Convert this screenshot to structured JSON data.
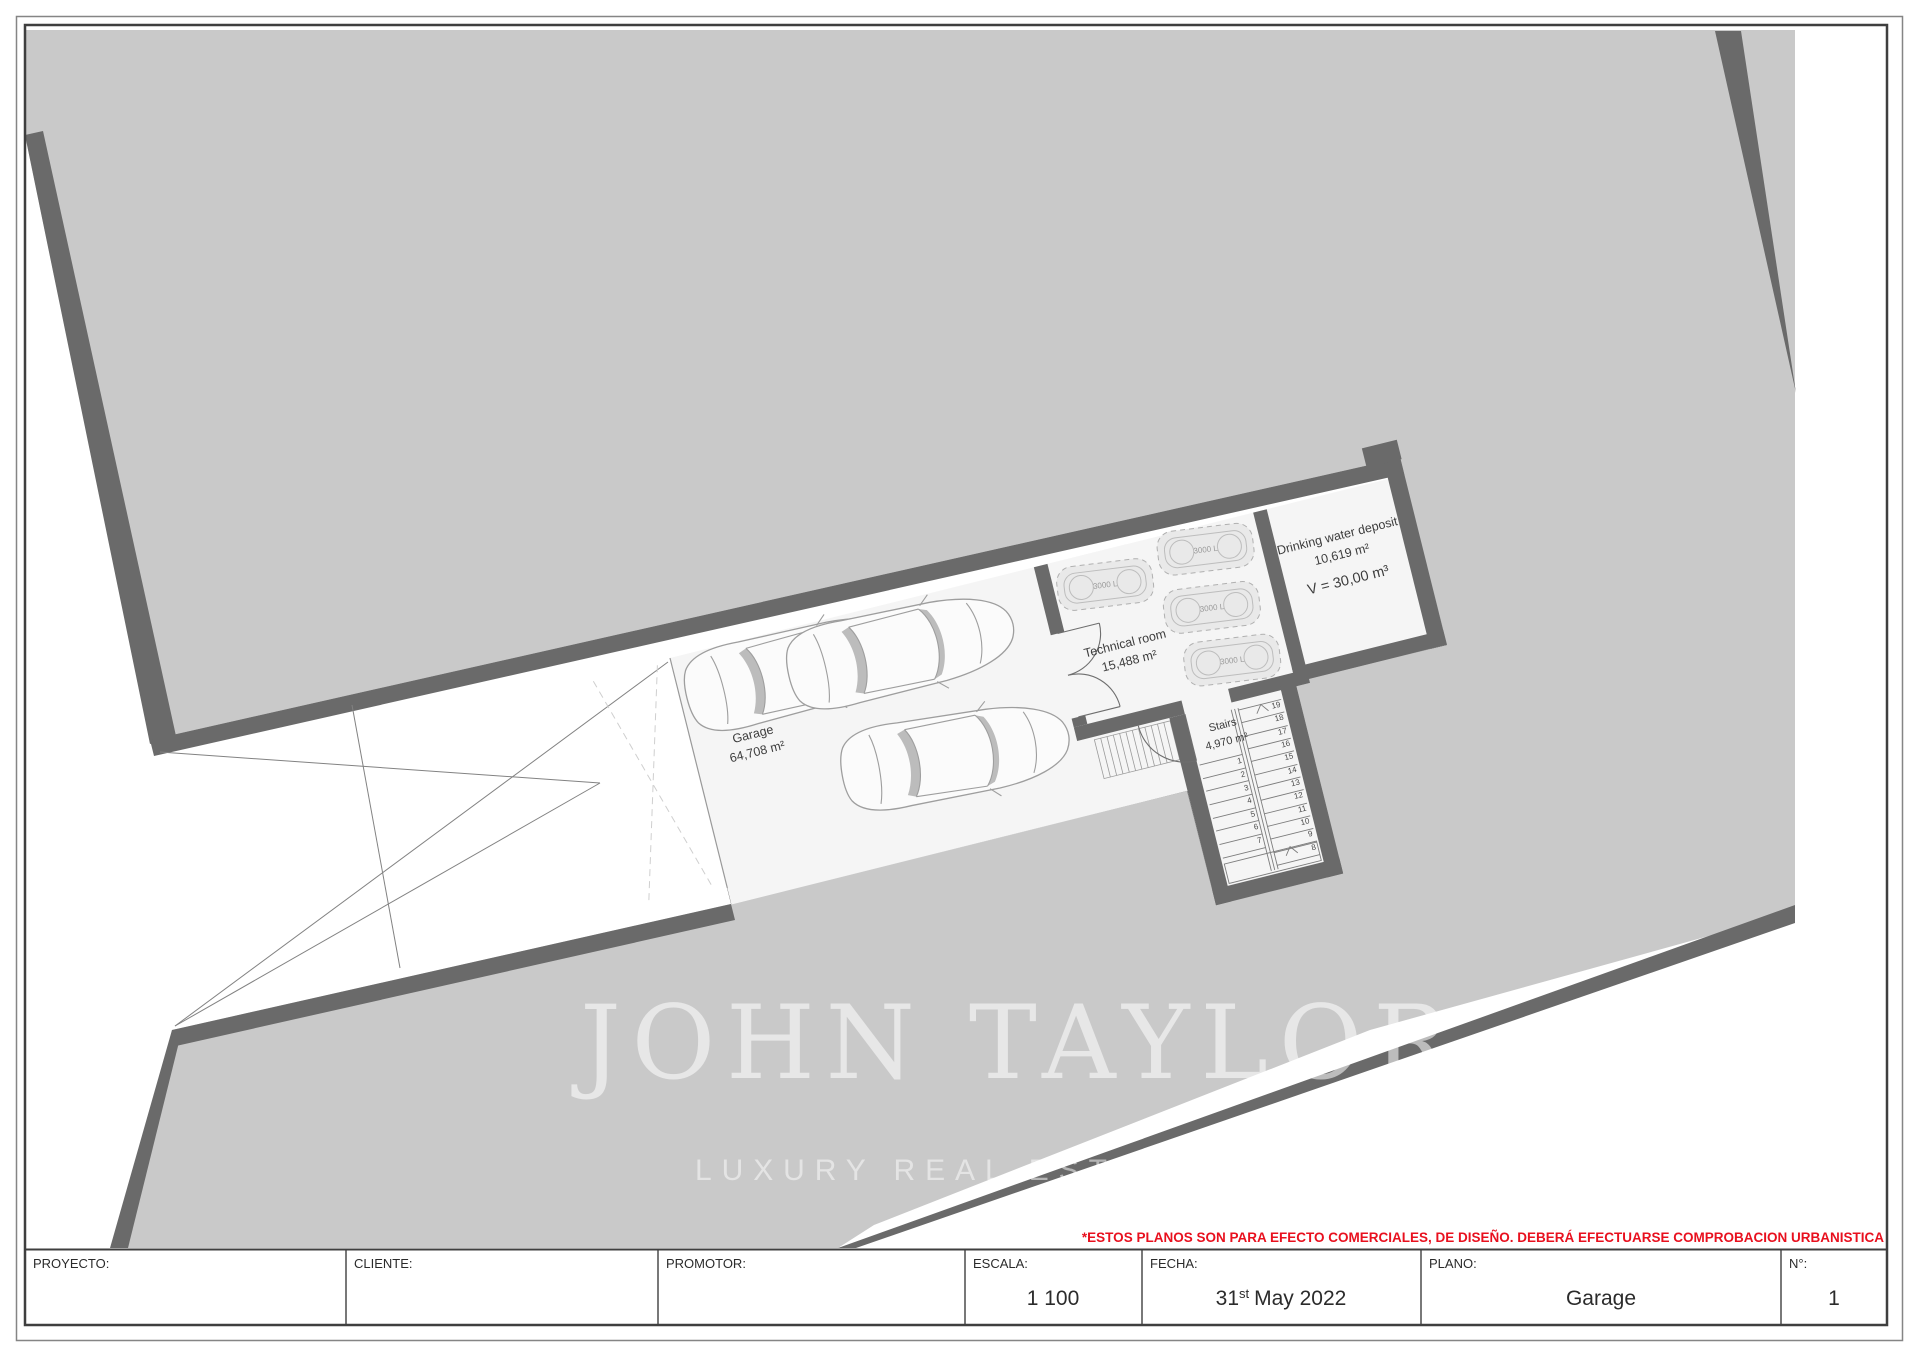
{
  "colors": {
    "terrain": "#c9c9c9",
    "wall": "#6a6a6a",
    "floor": "#f5f5f5",
    "accent_red": "#e8101e",
    "drawing_line": "#9a9a9a"
  },
  "plan": {
    "rooms": {
      "garage": {
        "name": "Garage",
        "area": "64,708 m²"
      },
      "technical": {
        "name": "Technical room",
        "area": "15,488 m²",
        "tank_label": "3000 L"
      },
      "deposit": {
        "name": "Drinking water deposit",
        "area": "10,619 m²",
        "volume": "V = 30,00 m³"
      },
      "stairs": {
        "name": "Stairs",
        "area": "4,970 m²",
        "left_numbers": [
          "1",
          "2",
          "3",
          "4",
          "5",
          "6",
          "7"
        ],
        "right_numbers": [
          "19",
          "18",
          "17",
          "16",
          "15",
          "14",
          "13",
          "12",
          "11",
          "10",
          "9",
          "8"
        ]
      }
    }
  },
  "watermark": {
    "line1": "JOHN TAYLOR",
    "line2": "LUXURY REAL ESTATE SINCE 1864"
  },
  "disclaimer": "*ESTOS PLANOS SON PARA EFECTO COMERCIALES, DE DISEÑO. DEBERÁ EFECTUARSE COMPROBACION URBANISTICA",
  "title_block": {
    "proyecto_label": "PROYECTO:",
    "proyecto_value": "",
    "cliente_label": "CLIENTE:",
    "cliente_value": "",
    "promotor_label": "PROMOTOR:",
    "promotor_value": "",
    "escala_label": "ESCALA:",
    "escala_value": "1 100",
    "fecha_label": "FECHA:",
    "fecha_day": "31",
    "fecha_suffix": "st",
    "fecha_rest": "May 2022",
    "plano_label": "PLANO:",
    "plano_value": "Garage",
    "numero_label": "N°:",
    "numero_value": "1"
  }
}
